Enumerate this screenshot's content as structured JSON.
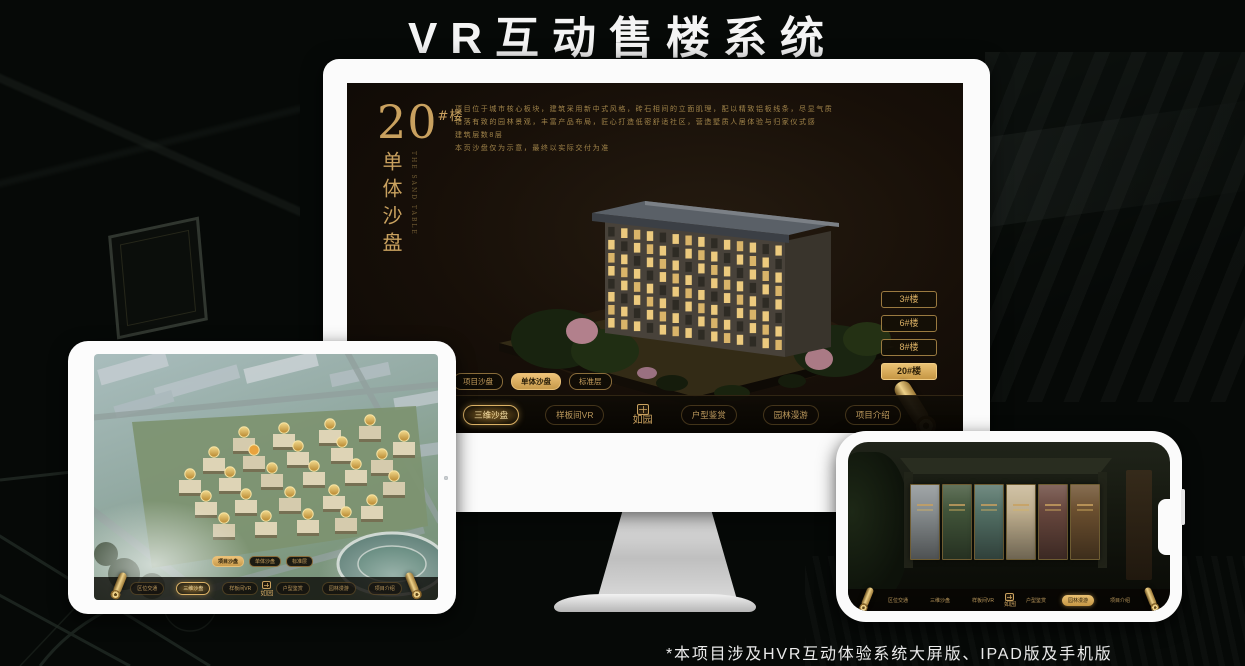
{
  "page": {
    "title": "VR互动售楼系统",
    "footnote": "*本项目涉及HVR互动体验系统大屏版、IPAD版及手机版"
  },
  "brand": "如园",
  "colors": {
    "gold": "#c9a15f",
    "gold_bright": "#e0b468",
    "gold_dim": "#8a6d3b",
    "screen_bg": "#17110a",
    "title_white": "#f4f4f4"
  },
  "monitor_ui": {
    "block_title": {
      "number": "20",
      "suffix": "#楼",
      "subtitle": "单体沙盘",
      "subtitle_en": "THE SAND TABLE"
    },
    "description_lines": [
      "项目位于城市核心板块，建筑采用新中式风格，砖石相间的立面肌理，配以精致铝板线条，尽显气质",
      "错落有致的园林景观，丰富产品布局，匠心打造低密舒适社区，营造墅质人居体验与归家仪式感",
      "建筑层数8层",
      "本页沙盘仅为示意，最终以实际交付为准"
    ],
    "floor_buttons": [
      {
        "label": "3#楼",
        "active": false
      },
      {
        "label": "6#楼",
        "active": false
      },
      {
        "label": "8#楼",
        "active": false
      },
      {
        "label": "20#楼",
        "active": true
      }
    ],
    "tabs": [
      {
        "label": "项目沙盘",
        "active": false
      },
      {
        "label": "单体沙盘",
        "active": true
      },
      {
        "label": "标准层",
        "active": false
      }
    ],
    "menu_left": [
      {
        "label": "区位交通",
        "active": false
      },
      {
        "label": "三维沙盘",
        "active": true
      },
      {
        "label": "样板间VR",
        "active": false
      }
    ],
    "menu_right": [
      {
        "label": "户型鉴赏",
        "active": false
      },
      {
        "label": "园林漫游",
        "active": false
      },
      {
        "label": "项目介绍",
        "active": false
      }
    ]
  },
  "tablet_ui": {
    "tabs": [
      {
        "label": "项目沙盘",
        "active": true
      },
      {
        "label": "单体沙盘",
        "active": false
      },
      {
        "label": "标准层",
        "active": false
      }
    ],
    "menu_left": [
      {
        "label": "区位交通",
        "active": false
      },
      {
        "label": "三维沙盘",
        "active": true
      },
      {
        "label": "样板间VR",
        "active": false
      }
    ],
    "menu_right": [
      {
        "label": "户型鉴赏",
        "active": false
      },
      {
        "label": "园林漫游",
        "active": false
      },
      {
        "label": "项目介绍",
        "active": false
      }
    ]
  },
  "phone_ui": {
    "menu_left": [
      {
        "label": "区位交通",
        "active": false
      },
      {
        "label": "三维沙盘",
        "active": false
      },
      {
        "label": "样板间VR",
        "active": false
      }
    ],
    "menu_right": [
      {
        "label": "户型鉴赏",
        "active": false
      },
      {
        "label": "园林漫游",
        "active": true
      },
      {
        "label": "项目介绍",
        "active": false
      }
    ],
    "panels": [
      {
        "color": "#8e9496"
      },
      {
        "color": "#44583c"
      },
      {
        "color": "#57756a"
      },
      {
        "color": "#c8b795"
      },
      {
        "color": "#6c4a40"
      },
      {
        "color": "#6f5231"
      }
    ]
  }
}
